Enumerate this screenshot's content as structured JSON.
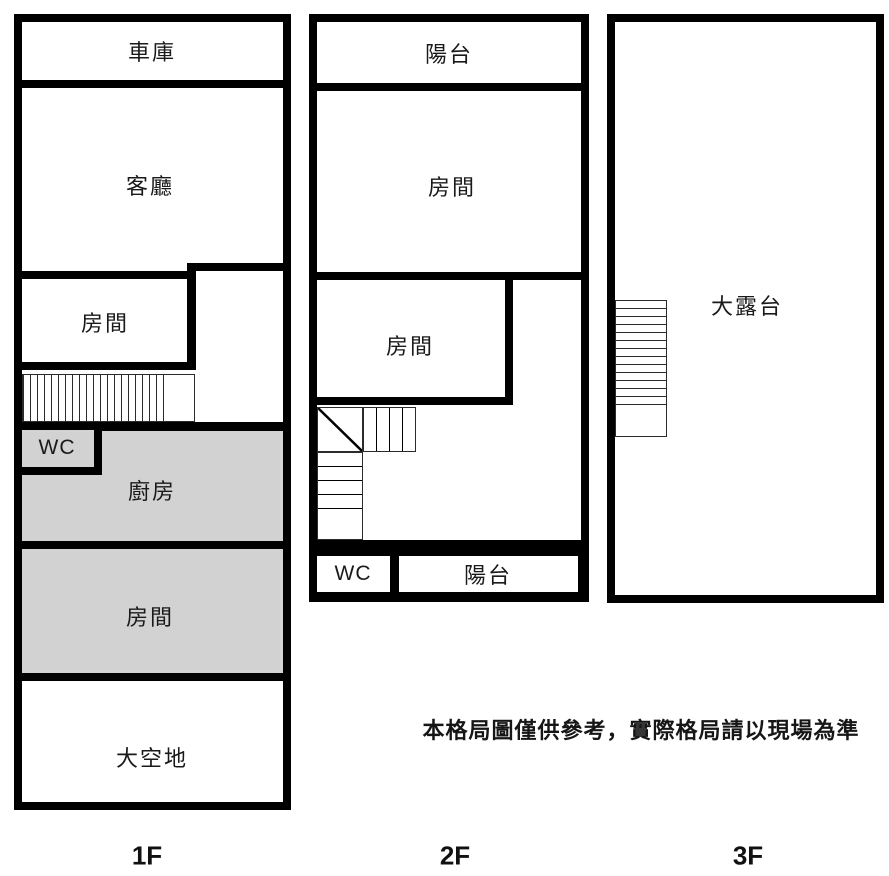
{
  "title": "floor-plan",
  "colors": {
    "wall": "#000000",
    "fill_gray": "#d2d2d2",
    "background": "#ffffff",
    "text": "#1a1a1a"
  },
  "floors": [
    {
      "label": "1F",
      "rooms": {
        "garage": "車庫",
        "living_room": "客廳",
        "room_upper": "房間",
        "wc": "WC",
        "kitchen": "廚房",
        "room_lower": "房間",
        "open_space": "大空地"
      }
    },
    {
      "label": "2F",
      "rooms": {
        "balcony_front": "陽台",
        "room_front": "房間",
        "room_middle": "房間",
        "wc": "WC",
        "balcony_rear": "陽台"
      }
    },
    {
      "label": "3F",
      "rooms": {
        "terrace": "大露台"
      }
    }
  ],
  "disclaimer": "本格局圖僅供參考，實際格局請以現場為準"
}
